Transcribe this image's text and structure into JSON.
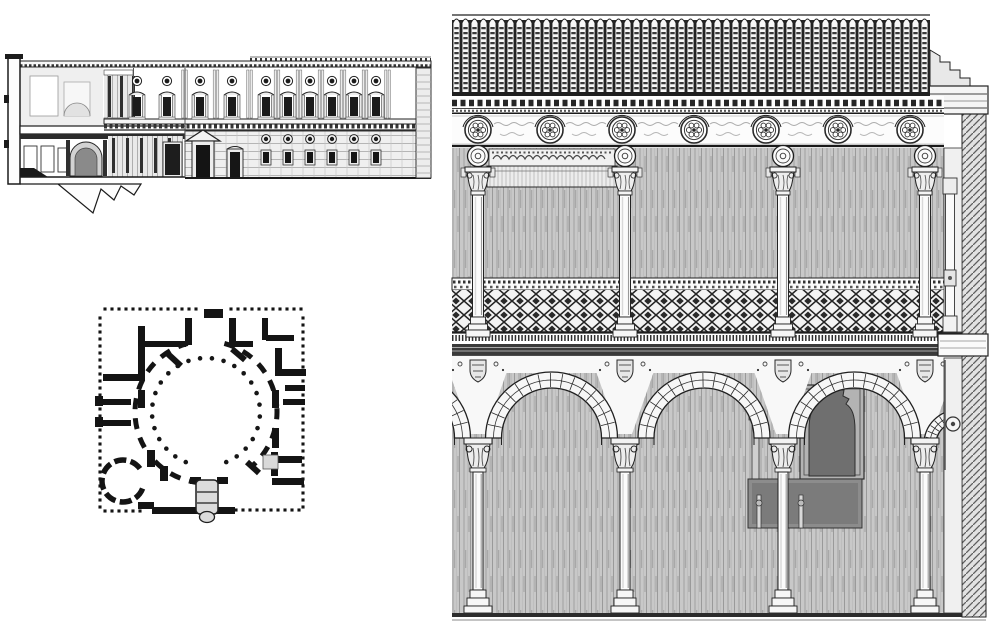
{
  "page": {
    "background": "#ffffff",
    "ink": "#1c1c1c",
    "wall_grey": "#c8c8c8",
    "dark_grey": "#8c8c8c",
    "description_labels": {
      "plate": "architectural-engraving-plate",
      "fig1": "palace-section-and-facade-elevation",
      "fig2": "palace-floor-plan-with-circular-courtyard",
      "fig3": "two-storey-courtyard-arcade-elevation"
    }
  },
  "figures": {
    "section_elevation": {
      "region": {
        "x": 0,
        "y": 40,
        "w": 440,
        "h": 185
      },
      "cornice": {
        "x0": 20,
        "x1": 431,
        "y": 61,
        "h": 6
      },
      "roof_dash": {
        "x0": 250,
        "x1": 431,
        "y": 57
      },
      "left_wall": {
        "x": 8,
        "y": 56,
        "w": 12,
        "h": 128
      },
      "slab": {
        "x": 20,
        "y": 126,
        "w": 165,
        "h": 8
      },
      "entablature": {
        "x0": 104,
        "x1": 431,
        "y": 119,
        "h": 11
      },
      "upper_window_xs": [
        137,
        167,
        200,
        232,
        266,
        288,
        310,
        332,
        354,
        376
      ],
      "pilaster_xs": [
        184.5,
        216,
        249.5,
        277,
        299,
        321,
        343,
        365,
        387.5
      ],
      "oculus_cy": 81,
      "window_y": 97,
      "porthole_xs": [
        266,
        288,
        310,
        332,
        354,
        376
      ],
      "porthole_cy": 139,
      "portal": {
        "cx": 203,
        "ped_y": 130,
        "door_y": 145
      },
      "side_door": {
        "x": 227,
        "y": 149
      },
      "inner_door": {
        "x": 165,
        "y": 144
      },
      "niche": {
        "x0": 70,
        "x1": 102,
        "spring_y": 158,
        "base_y": 176
      },
      "upper_colonnade": {
        "x0": 104,
        "x1": 133,
        "y0": 70,
        "y1": 124,
        "n": 2
      },
      "lower_colonnade": {
        "x0": 108,
        "x1": 183,
        "y0": 136,
        "y1": 177,
        "n": 5
      },
      "corner_strip": {
        "x": 416,
        "y": 68,
        "w": 15,
        "h": 110
      },
      "ground_y": 178,
      "jagged": [
        [
          20,
          184
        ],
        [
          58,
          184
        ],
        [
          93,
          213
        ],
        [
          101,
          189
        ],
        [
          114,
          200
        ],
        [
          121,
          186
        ],
        [
          134,
          195
        ],
        [
          141,
          184
        ]
      ]
    },
    "floor_plan": {
      "square": {
        "x0": 103,
        "y0": 312,
        "x1": 305,
        "y1": 514
      },
      "border_dot": {
        "size": 3.1,
        "step": 7
      },
      "courtyard": {
        "cx": 206,
        "cy": 412,
        "ring_r": 54,
        "ring_dots": 26,
        "ring_gap_center_deg": 90,
        "ring_gap_half_deg": 22,
        "wall_r": 71,
        "wall_arcs_deg": [
          [
            150,
            255
          ],
          [
            285,
            355
          ],
          [
            357,
            412
          ],
          [
            95,
            140
          ]
        ],
        "diag_stubs": [
          [
            168,
            354,
            181,
            366
          ],
          [
            232,
            349,
            245,
            360
          ],
          [
            247,
            462,
            259,
            473
          ]
        ]
      },
      "chapel": {
        "cx": 123,
        "cy": 481,
        "r": 21,
        "segments": 7
      },
      "vestibule": {
        "x": 196,
        "y": 480,
        "w": 22,
        "h": 34
      },
      "entrance_blob": {
        "x": 204,
        "y": 309,
        "w": 19,
        "h": 9
      },
      "grey_block": {
        "x": 263,
        "y": 455,
        "w": 15,
        "h": 14
      },
      "walls": [
        [
          138,
          326,
          7,
          52
        ],
        [
          103,
          374,
          42,
          7
        ],
        [
          145,
          341,
          26,
          6
        ],
        [
          185,
          318,
          7,
          27
        ],
        [
          164,
          341,
          22,
          6
        ],
        [
          229,
          318,
          7,
          27
        ],
        [
          231,
          341,
          22,
          6
        ],
        [
          262,
          318,
          6,
          22
        ],
        [
          266,
          335,
          28,
          6
        ],
        [
          275,
          348,
          7,
          28
        ],
        [
          282,
          369,
          24,
          7
        ],
        [
          285,
          385,
          20,
          6
        ],
        [
          272,
          390,
          7,
          18
        ],
        [
          283,
          399,
          22,
          6
        ],
        [
          103,
          399,
          28,
          6
        ],
        [
          103,
          420,
          28,
          6
        ],
        [
          95,
          396,
          8,
          10
        ],
        [
          95,
          417,
          8,
          10
        ],
        [
          272,
          428,
          7,
          20
        ],
        [
          278,
          456,
          24,
          7
        ],
        [
          271,
          452,
          7,
          24
        ],
        [
          272,
          478,
          32,
          7
        ],
        [
          138,
          390,
          7,
          18
        ],
        [
          190,
          477,
          11,
          7
        ],
        [
          217,
          477,
          11,
          7
        ],
        [
          152,
          507,
          83,
          7
        ],
        [
          147,
          450,
          8,
          17
        ],
        [
          160,
          466,
          8,
          15
        ],
        [
          138,
          502,
          16,
          7
        ]
      ]
    },
    "courtyard_elevation": {
      "region": {
        "x": 444,
        "y": 0,
        "w": 556,
        "h": 626
      },
      "columns_x": [
        478,
        625,
        783,
        925
      ],
      "roof": {
        "x0": 452,
        "x1": 930,
        "y_top": 15,
        "y_bottom": 93,
        "tile_w": 9
      },
      "frieze": {
        "y0": 114,
        "y1": 146,
        "medallion_xs": [
          478,
          550,
          622,
          694,
          766,
          838,
          910
        ],
        "cy": 130,
        "r_outer": 13,
        "r_inner": 9.6
      },
      "roundel": {
        "cy": 156,
        "r": 10.5
      },
      "gallery": {
        "wall_y0": 148,
        "wall_y1": 278,
        "carved_band": {
          "x": 489,
          "y": 149,
          "w": 126,
          "h": 17
        },
        "beam": {
          "x": 487,
          "y": 166,
          "w": 130,
          "h": 21
        }
      },
      "parapet": {
        "dot_y0": 278,
        "dot_y1": 290,
        "lat_y0": 290,
        "lat_y1": 332
      },
      "floor_band": {
        "y0": 333,
        "y1": 356
      },
      "arcade": {
        "cy": 438,
        "r_outer": 66,
        "r_inner": 50,
        "bay_mids": [
          404.5,
          551.5,
          704,
          854.5
        ],
        "cap_y0": 438,
        "base_y": 590,
        "ground_y": 613
      },
      "doorway": {
        "dark": [
          748,
          479,
          114,
          49
        ],
        "alfiz": [
          800,
          385,
          64,
          94
        ]
      },
      "pier": {
        "face_x": 944,
        "face_w": 18,
        "hatch_x": 962,
        "hatch_w": 24,
        "slab": [
          938,
          334,
          50,
          22
        ],
        "roundel": [
          953,
          424,
          7
        ],
        "section_column_x": 950
      }
    }
  }
}
